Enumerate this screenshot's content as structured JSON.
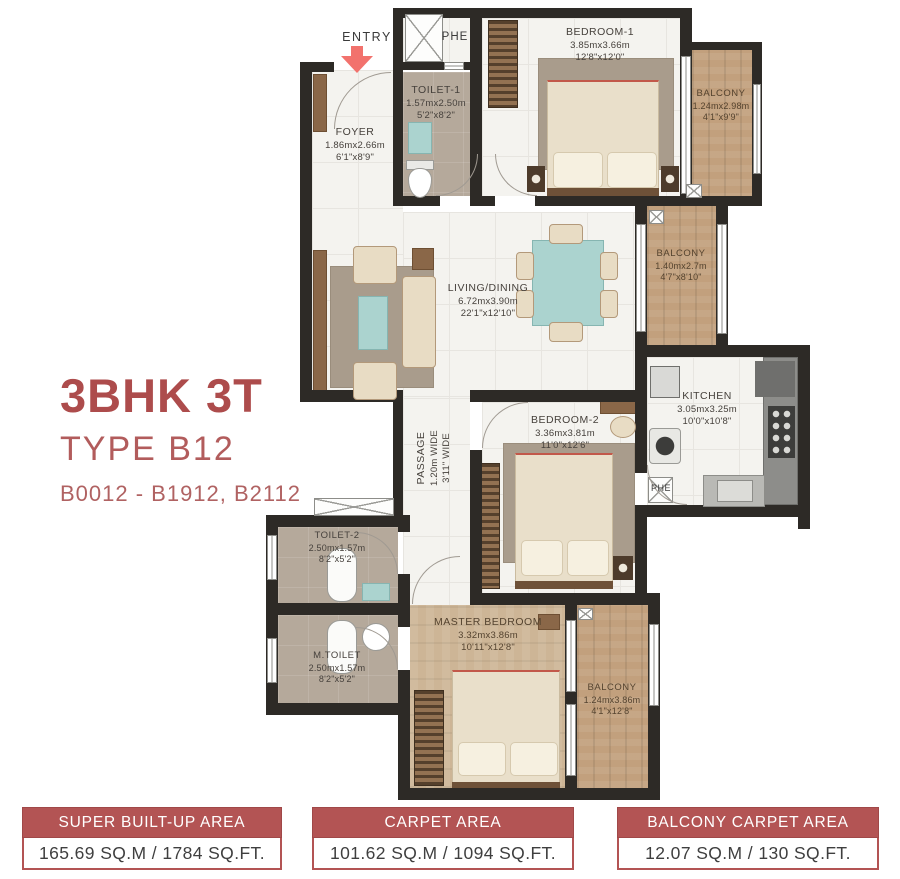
{
  "title": {
    "heading": "3BHK 3T",
    "subheading": "TYPE B12",
    "units": "B0012 - B1912, B2112"
  },
  "entry": {
    "label": "ENTRY"
  },
  "rooms": [
    {
      "name": "FOYER",
      "dim_m": "1.86mx2.66m",
      "dim_ft": "6'1\"x8'9\""
    },
    {
      "name": "TOILET-1",
      "dim_m": "1.57mx2.50m",
      "dim_ft": "5'2\"x8'2\""
    },
    {
      "name": "PHE"
    },
    {
      "name": "BEDROOM-1",
      "dim_m": "3.85mx3.66m",
      "dim_ft": "12'8\"x12'0\""
    },
    {
      "name": "BALCONY",
      "dim_m": "1.24mx2.98m",
      "dim_ft": "4'1\"x9'9\""
    },
    {
      "name": "BALCONY",
      "dim_m": "1.40mx2.7m",
      "dim_ft": "4'7\"x8'10\""
    },
    {
      "name": "LIVING/DINING",
      "dim_m": "6.72mx3.90m",
      "dim_ft": "22'1\"x12'10\""
    },
    {
      "name": "KITCHEN",
      "dim_m": "3.05mx3.25m",
      "dim_ft": "10'0\"x10'8\""
    },
    {
      "name": "PHE"
    },
    {
      "name": "BEDROOM-2",
      "dim_m": "3.36mx3.81m",
      "dim_ft": "11'0\"x12'6\""
    },
    {
      "name": "PASSAGE",
      "dim_m": "1.20m WIDE",
      "dim_ft": "3'11\" WIDE"
    },
    {
      "name": "TOILET-2",
      "dim_m": "2.50mx1.57m",
      "dim_ft": "8'2\"x5'2\""
    },
    {
      "name": "M.TOILET",
      "dim_m": "2.50mx1.57m",
      "dim_ft": "8'2\"x5'2\""
    },
    {
      "name": "MASTER BEDROOM",
      "dim_m": "3.32mx3.86m",
      "dim_ft": "10'11\"x12'8\""
    },
    {
      "name": "BALCONY",
      "dim_m": "1.24mx3.86m",
      "dim_ft": "4'1\"x12'8\""
    }
  ],
  "area_summary": [
    {
      "label": "SUPER BUILT-UP AREA",
      "value": "165.69 SQ.M / 1784 SQ.FT."
    },
    {
      "label": "CARPET AREA",
      "value": "101.62 SQ.M / 1094 SQ.FT."
    },
    {
      "label": "BALCONY CARPET AREA",
      "value": "12.07 SQ.M / 130 SQ.FT."
    }
  ],
  "colors": {
    "accent_maroon": "#b35454",
    "wall": "#2d2a26",
    "balcony_wood": "#c2a07d",
    "teal": "#abd3cf",
    "entry_arrow": "#f2726d"
  }
}
